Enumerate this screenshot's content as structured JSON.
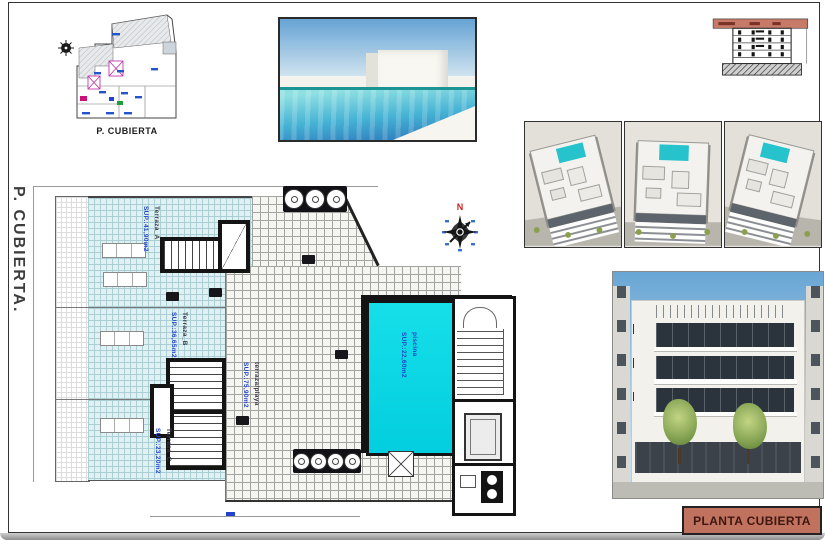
{
  "sheet": {
    "side_label": "P. CUBIERTA.",
    "title": "PLANTA CUBIERTA"
  },
  "key_plan": {
    "caption": "P. CUBIERTA"
  },
  "compass": {
    "north_label": "N"
  },
  "plan": {
    "areas": [
      {
        "id": "terraza_a",
        "name": "Terraza_A",
        "sup": "SUP.:41,90m2"
      },
      {
        "id": "terraza_b",
        "name": "Terraza_B",
        "sup": "SUP.:36,65m2"
      },
      {
        "id": "terraza_c",
        "name": "Terraza_C",
        "sup": "SUP.:23,20m2"
      },
      {
        "id": "terraza_playa",
        "name": "terraza/playa",
        "sup": "SUP.:75,90m2"
      },
      {
        "id": "piscina",
        "name": "piscina",
        "sup": "SUP.:22,60m2"
      }
    ]
  },
  "colors": {
    "title_bg": "#c0725f",
    "pool_fill": "#09dce8",
    "terrace_tile": "#e0f1f3",
    "accent_blue": "#2244cc",
    "north_red": "#cc2222",
    "section_highlight": "#c87a68"
  }
}
